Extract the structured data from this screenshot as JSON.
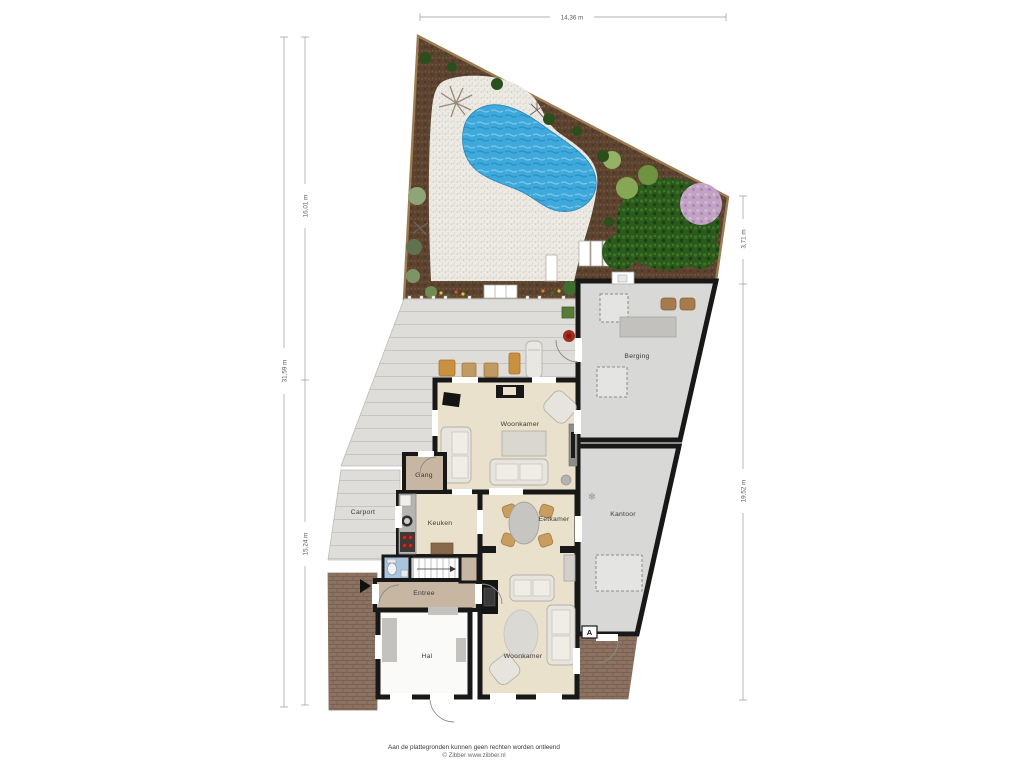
{
  "plan": {
    "dimensions": {
      "width_top": "14,36 m",
      "left_total": "31,59 m",
      "left_upper": "16,01 m",
      "left_lower": "15,24 m",
      "right_upper": "3,71 m",
      "right_lower": "19,52 m"
    },
    "rooms": {
      "woonkamer_top": "Woonkamer",
      "berging": "Berging",
      "gang": "Gang",
      "carport": "Carport",
      "keuken": "Keuken",
      "eetkamer": "Eetkamer",
      "kantoor": "Kantoor",
      "entree": "Entree",
      "hal": "Hal",
      "woonkamer_bottom": "Woonkamer"
    },
    "markers": {
      "section_a": "A"
    },
    "icons": {
      "hvac_glyph": "❄"
    },
    "colors": {
      "wall": "#181818",
      "floor_living": "#e9e1cb",
      "floor_hall": "#c7b6a1",
      "floor_storage": "#d8d8d6",
      "floor_white": "#fafaf8",
      "pool": "#3fa9dc",
      "soil": "#5c4330",
      "gravel": "#eceae3",
      "deck": "#deddd9",
      "brick": "#8b7262",
      "bush": "#2c5a1d"
    },
    "footer": {
      "disclaimer": "Aan de plattegronden kunnen geen rechten worden ontleend",
      "copyright": "© Zibber www.zibber.nl"
    }
  }
}
